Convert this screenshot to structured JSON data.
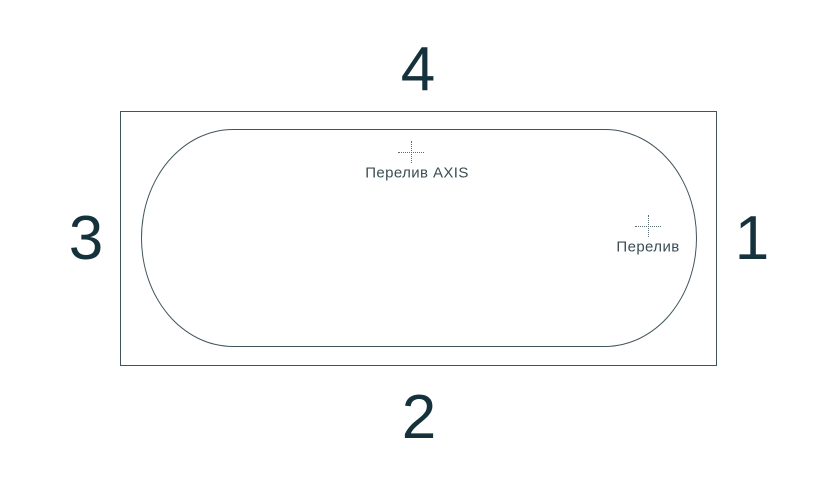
{
  "diagram": {
    "name": "bathtub-top-view-overflow-positions",
    "sides": {
      "top": "4",
      "bottom": "2",
      "left": "3",
      "right": "1"
    },
    "markers": [
      {
        "id": "overflow-axis",
        "label": "Перелив AXIS"
      },
      {
        "id": "overflow-standard",
        "label": "Перелив"
      }
    ],
    "colors": {
      "background": "#ffffff",
      "outline": "#40545b",
      "number_text": "#14313c",
      "label_text": "#3a4e54",
      "crosshair": "#5d6f75"
    }
  }
}
